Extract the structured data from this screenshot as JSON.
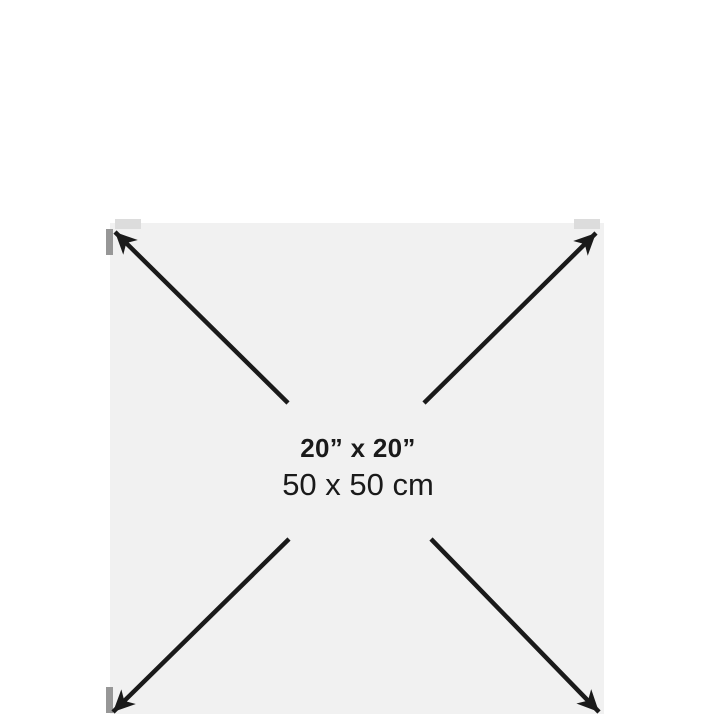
{
  "diagram": {
    "size_label_inches": "20” x 20”",
    "size_label_cm": "50 x 50 cm"
  },
  "theme": {
    "bg": "#ffffff",
    "square-fill": "#f1f1f1",
    "arrow-color": "#1a1a1a",
    "text-color": "#1a1a1a",
    "corner-tab-light": "#dcdcdc",
    "corner-tab-dark": "#979797"
  }
}
